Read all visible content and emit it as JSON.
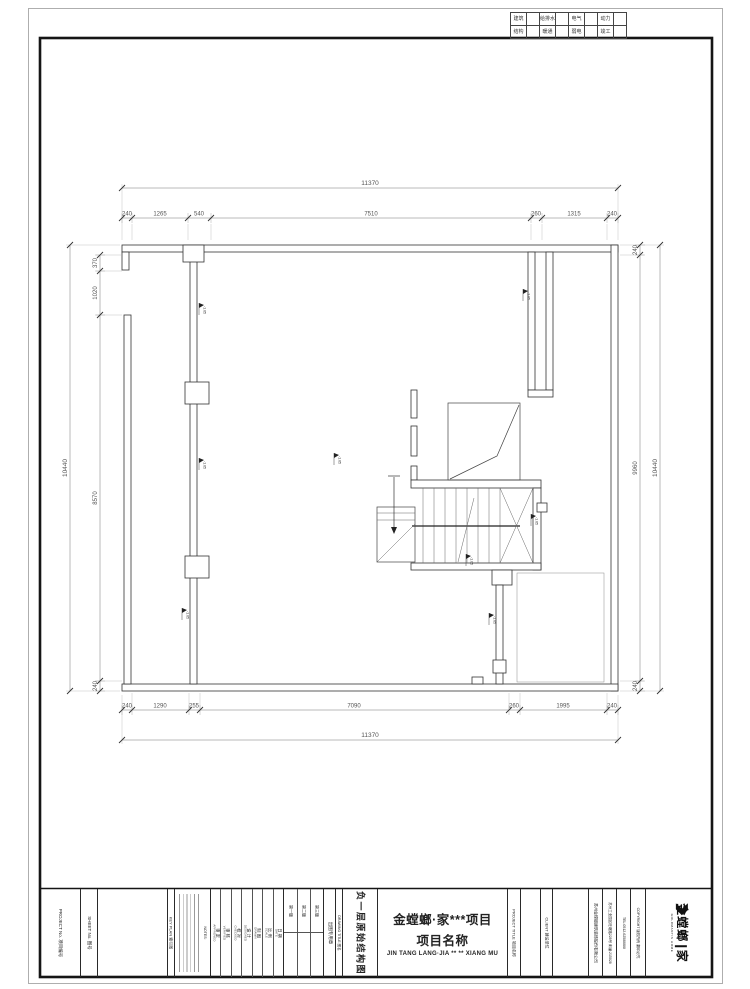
{
  "sheet": {
    "disciplines": {
      "row1": [
        {
          "label": "建筑"
        },
        {
          "label": "给排水"
        },
        {
          "label": "电气"
        },
        {
          "label": "动力"
        }
      ],
      "row2": [
        {
          "label": "结构"
        },
        {
          "label": "暖通"
        },
        {
          "label": "弱电"
        },
        {
          "label": "竣工"
        }
      ]
    }
  },
  "plan": {
    "marker_label": "-1.05",
    "dims": {
      "top_overall": "11370",
      "top": [
        "240",
        "1265",
        "540",
        "7510",
        "260",
        "1315",
        "240"
      ],
      "bottom": [
        "240",
        "1290",
        "255",
        "7090",
        "260",
        "1995",
        "240"
      ],
      "bottom_overall": "11370",
      "left_overall": "10440",
      "left": [
        "370",
        "1020",
        "8570",
        "240"
      ],
      "right": [
        "240",
        "9960",
        "240"
      ],
      "right_overall": "10440"
    }
  },
  "titleblock": {
    "project_no": "PROJECT No.  项目编号",
    "sheet_no": "SHEET No.  图号",
    "key_plan": "KEY PLAN  索引图",
    "notes_title": "NOTES:",
    "sign_cols": [
      {
        "cn": "审 定",
        "en": "APPROVED"
      },
      {
        "cn": "审 核",
        "en": "VERIFIED"
      },
      {
        "cn": "校 对",
        "en": "CHECKED"
      },
      {
        "cn": "设 计",
        "en": "DESIGNED"
      },
      {
        "cn": "制 图",
        "en": "DRAWN"
      },
      {
        "cn": "比 例",
        "en": "SCALE"
      },
      {
        "cn": "日 期",
        "en": "DATE"
      }
    ],
    "versions": [
      "第一版",
      "第二版",
      "第三版"
    ],
    "seal": "出图专用章",
    "drawing_title_label": "DRAWING TITLE  图名",
    "drawing_title": "负一层原始结构图",
    "project_title_label": "PROJECT TITLE  项目名称",
    "project": {
      "line1": "金螳螂·家***项目",
      "line2": "项目名称",
      "line3": "JIN TANG LANG·JIA ** ** XIANG MU"
    },
    "client_label": "CLIENT  建设单位",
    "company": {
      "name": "苏州金螳螂建筑装饰股份有限公司",
      "address": "苏州工业园区旺墩路228号 邮编:215028",
      "tel": "TEL:0512-62588888",
      "copyright": "COPYRIGHT 版权所有 翻印必究"
    },
    "logo": {
      "cn1": "金螳螂",
      "cn2": "家",
      "en": "GOLDMANTIS HOME"
    }
  }
}
